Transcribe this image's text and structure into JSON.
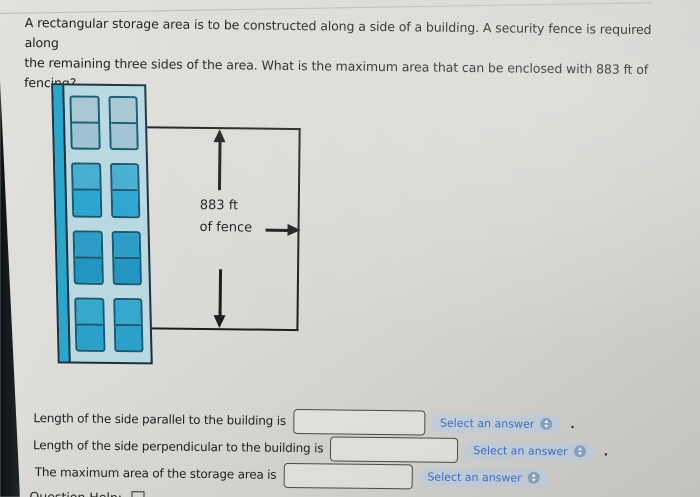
{
  "question": {
    "lines": [
      "A rectangular storage area is to be constructed along a side of a building. A security fence is required along",
      "the remaining three sides of the area. What is the maximum area that can be enclosed with 883 ft of fencing?"
    ]
  },
  "diagram": {
    "fence_label": [
      "883 ft",
      "of fence"
    ]
  },
  "answers": {
    "rows": [
      {
        "label": "Length of the side parallel to the building is",
        "value": "",
        "select": "Select an answer",
        "suffix": "."
      },
      {
        "label": "Length of the side perpendicular to the building is",
        "value": "",
        "select": "Select an answer",
        "suffix": "."
      },
      {
        "label": "The maximum area of the storage area is",
        "value": "",
        "select": "Select an answer",
        "suffix": ""
      }
    ]
  },
  "footer": {
    "label": "Question Help:"
  },
  "icons": {
    "select_stepper": "up-down-arrows-in-circle",
    "footer_box": "video-icon",
    "diagram_arrows": "dimension-arrows"
  },
  "colors": {
    "page_bg": "#d8d6d2",
    "building_body": "#b9d8e2",
    "building_stripe": "#2ba6ca",
    "window_border": "#155a70",
    "window_teal": "#2da6cf",
    "fence_line": "#1e1e20",
    "select_pill_bg": "#c7d2de",
    "select_text": "#3e70c6",
    "dark_edge": "#0d1115"
  }
}
